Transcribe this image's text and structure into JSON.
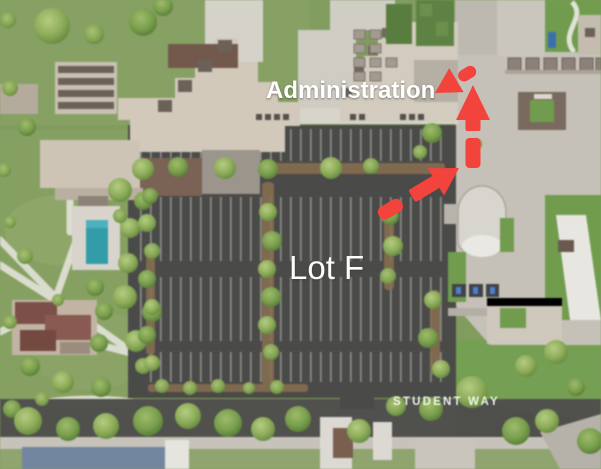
{
  "page": {
    "labels": {
      "administration": "Administration",
      "lot_f": "Lot F",
      "street": "STUDENT WAY"
    },
    "icons": {
      "route_arrows": "red-dashed-route-arrow"
    },
    "colors": {
      "arrow": "#f2433c",
      "asphalt": "#4a4a48",
      "grass": "#809d5c",
      "grass_bright": "#6f9d4b",
      "pavement": "#c6c1b8",
      "pool": "#2f9dab",
      "label": "#ffffff"
    }
  }
}
